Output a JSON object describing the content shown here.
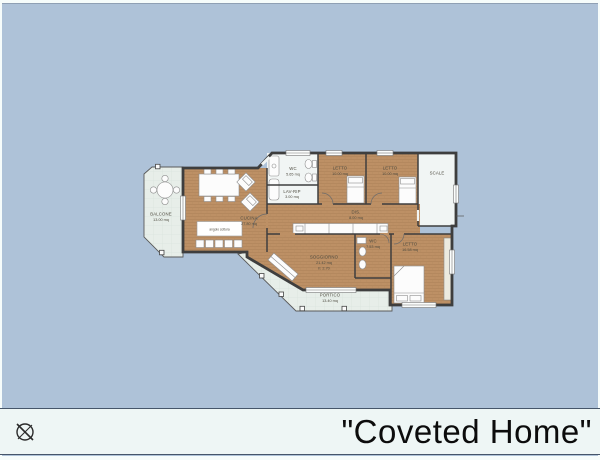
{
  "title_block": {
    "text": "\"Coveted Home\""
  },
  "colors": {
    "background": "#aec2d8",
    "wall": "#3e3e3e",
    "wood_floor": "#bd9065",
    "outdoor_floor": "#e7eee9",
    "white_room_floor": "#f1f5f4",
    "title_bar": "#eef6f5",
    "title_text": "#0c0c0c"
  },
  "icons": {
    "bottom_left": "crossed-circle-icon"
  },
  "rooms": {
    "balcone": {
      "name": "BALCONE",
      "area": "13.00 mq"
    },
    "cucina": {
      "name": "CUCINA",
      "area": "27.80 mq",
      "kitchenette": "angolo cottura"
    },
    "wc_top": {
      "name": "WC",
      "area": "5.65 mq"
    },
    "lav_rip": {
      "name": "LAV-RIP",
      "area": "3.00 mq"
    },
    "letto_1": {
      "name": "LETTO",
      "area": "10.00 mq"
    },
    "letto_2": {
      "name": "LETTO",
      "area": "10.00 mq"
    },
    "scale": {
      "name": "SCALE"
    },
    "dis": {
      "name": "DIS.",
      "area": "8.00 mq"
    },
    "wc_main": {
      "name": "WC",
      "area": "7.53 mq"
    },
    "letto_3": {
      "name": "LETTO",
      "area": "16.58 mq"
    },
    "soggiorno": {
      "name": "SOGGIORNO",
      "area": "21.42 mq",
      "height": "h: 2.70"
    },
    "portico": {
      "name": "PORTICO",
      "area": "13.40 mq"
    }
  }
}
